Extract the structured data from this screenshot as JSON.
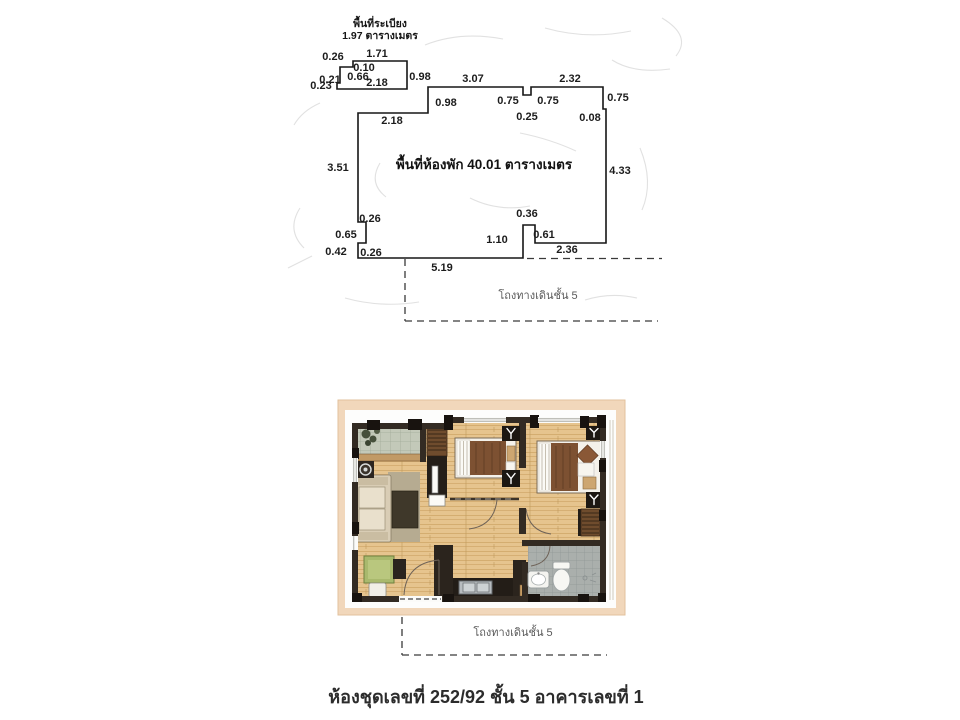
{
  "colors": {
    "paper": "#ffffff",
    "line": "#161616",
    "card_tan": "#f1d7bb",
    "wall_dark": "#332b23",
    "wood_floor": "#e6c48e",
    "balcony_tile": "#c3c9b9",
    "bath_tile": "#aaafac",
    "blanket_brown": "#7d5132",
    "rug": "#b6ab91",
    "desk_green": "#a9b96d"
  },
  "upper_plan": {
    "balcony_area_label": [
      "พื้นที่ระเบียง",
      "1.97 ตารางเมตร"
    ],
    "room_area_label": "พื้นที่ห้องพัก 40.01  ตารางเมตร",
    "corridor_label": "โถงทางเดินชั้น 5",
    "dimensions": [
      {
        "v": "0.26",
        "x": 333,
        "y": 60
      },
      {
        "v": "1.71",
        "x": 377,
        "y": 57
      },
      {
        "v": "0.10",
        "x": 364,
        "y": 71
      },
      {
        "v": "0.66",
        "x": 358,
        "y": 80
      },
      {
        "v": "0.21",
        "x": 330,
        "y": 83
      },
      {
        "v": "0.23",
        "x": 321,
        "y": 89
      },
      {
        "v": "2.18",
        "x": 377,
        "y": 86
      },
      {
        "v": "0.98",
        "x": 420,
        "y": 80
      },
      {
        "v": "0.98",
        "x": 446,
        "y": 106
      },
      {
        "v": "3.07",
        "x": 473,
        "y": 82
      },
      {
        "v": "2.32",
        "x": 570,
        "y": 82
      },
      {
        "v": "0.75",
        "x": 508,
        "y": 104
      },
      {
        "v": "0.75",
        "x": 548,
        "y": 104
      },
      {
        "v": "0.25",
        "x": 527,
        "y": 120
      },
      {
        "v": "0.75",
        "x": 618,
        "y": 101
      },
      {
        "v": "0.08",
        "x": 590,
        "y": 121
      },
      {
        "v": "2.18",
        "x": 392,
        "y": 124
      },
      {
        "v": "3.51",
        "x": 338,
        "y": 171
      },
      {
        "v": "4.33",
        "x": 620,
        "y": 174
      },
      {
        "v": "0.26",
        "x": 370,
        "y": 222
      },
      {
        "v": "0.65",
        "x": 346,
        "y": 238
      },
      {
        "v": "0.42",
        "x": 336,
        "y": 255
      },
      {
        "v": "0.26",
        "x": 371,
        "y": 256
      },
      {
        "v": "5.19",
        "x": 442,
        "y": 271
      },
      {
        "v": "1.10",
        "x": 497,
        "y": 243
      },
      {
        "v": "0.36",
        "x": 527,
        "y": 217
      },
      {
        "v": "0.61",
        "x": 544,
        "y": 238
      },
      {
        "v": "2.36",
        "x": 567,
        "y": 253
      }
    ]
  },
  "lower_plan": {
    "corridor_label": "โถงทางเดินชั้น 5"
  },
  "caption": "ห้องชุดเลขที่ 252/92 ชั้น 5 อาคารเลขที่ 1"
}
